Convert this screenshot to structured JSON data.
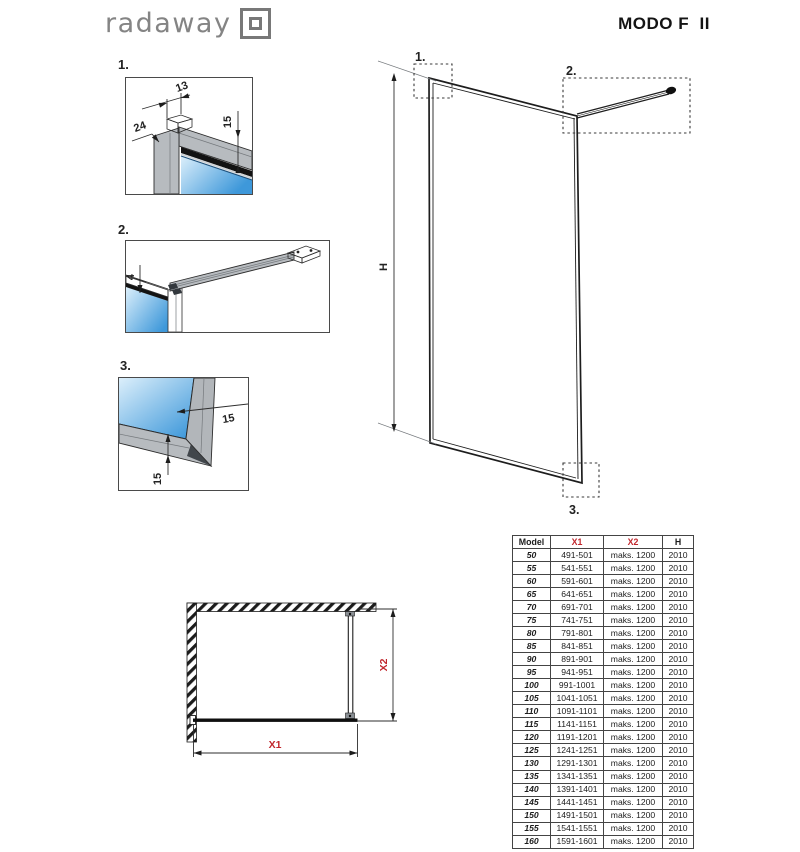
{
  "brand": {
    "logo_text": "radaway"
  },
  "page": {
    "title": "MODO F  II"
  },
  "callouts": {
    "c1": "1.",
    "c2": "2.",
    "c3": "3."
  },
  "dimensions": {
    "detail1": {
      "top": "13",
      "left": "24",
      "right": "15"
    },
    "detail2": {
      "glass": "4"
    },
    "detail3": {
      "side": "15",
      "bottom": "15"
    },
    "height": "H",
    "x1": "X1",
    "x2": "X2"
  },
  "table": {
    "columns": [
      "Model",
      "X1",
      "X2",
      "H"
    ],
    "rows": [
      [
        "50",
        "491-501",
        "maks. 1200",
        "2010"
      ],
      [
        "55",
        "541-551",
        "maks. 1200",
        "2010"
      ],
      [
        "60",
        "591-601",
        "maks. 1200",
        "2010"
      ],
      [
        "65",
        "641-651",
        "maks. 1200",
        "2010"
      ],
      [
        "70",
        "691-701",
        "maks. 1200",
        "2010"
      ],
      [
        "75",
        "741-751",
        "maks. 1200",
        "2010"
      ],
      [
        "80",
        "791-801",
        "maks. 1200",
        "2010"
      ],
      [
        "85",
        "841-851",
        "maks. 1200",
        "2010"
      ],
      [
        "90",
        "891-901",
        "maks. 1200",
        "2010"
      ],
      [
        "95",
        "941-951",
        "maks. 1200",
        "2010"
      ],
      [
        "100",
        "991-1001",
        "maks. 1200",
        "2010"
      ],
      [
        "105",
        "1041-1051",
        "maks. 1200",
        "2010"
      ],
      [
        "110",
        "1091-1101",
        "maks. 1200",
        "2010"
      ],
      [
        "115",
        "1141-1151",
        "maks. 1200",
        "2010"
      ],
      [
        "120",
        "1191-1201",
        "maks. 1200",
        "2010"
      ],
      [
        "125",
        "1241-1251",
        "maks. 1200",
        "2010"
      ],
      [
        "130",
        "1291-1301",
        "maks. 1200",
        "2010"
      ],
      [
        "135",
        "1341-1351",
        "maks. 1200",
        "2010"
      ],
      [
        "140",
        "1391-1401",
        "maks. 1200",
        "2010"
      ],
      [
        "145",
        "1441-1451",
        "maks. 1200",
        "2010"
      ],
      [
        "150",
        "1491-1501",
        "maks. 1200",
        "2010"
      ],
      [
        "155",
        "1541-1551",
        "maks. 1200",
        "2010"
      ],
      [
        "160",
        "1591-1601",
        "maks. 1200",
        "2010"
      ]
    ]
  },
  "colors": {
    "accent_red": "#c1262c",
    "glass_light": "#d9edfb",
    "glass_dark": "#3e98da",
    "profile_gray": "#b7bbbf",
    "line_dark": "#222222"
  }
}
